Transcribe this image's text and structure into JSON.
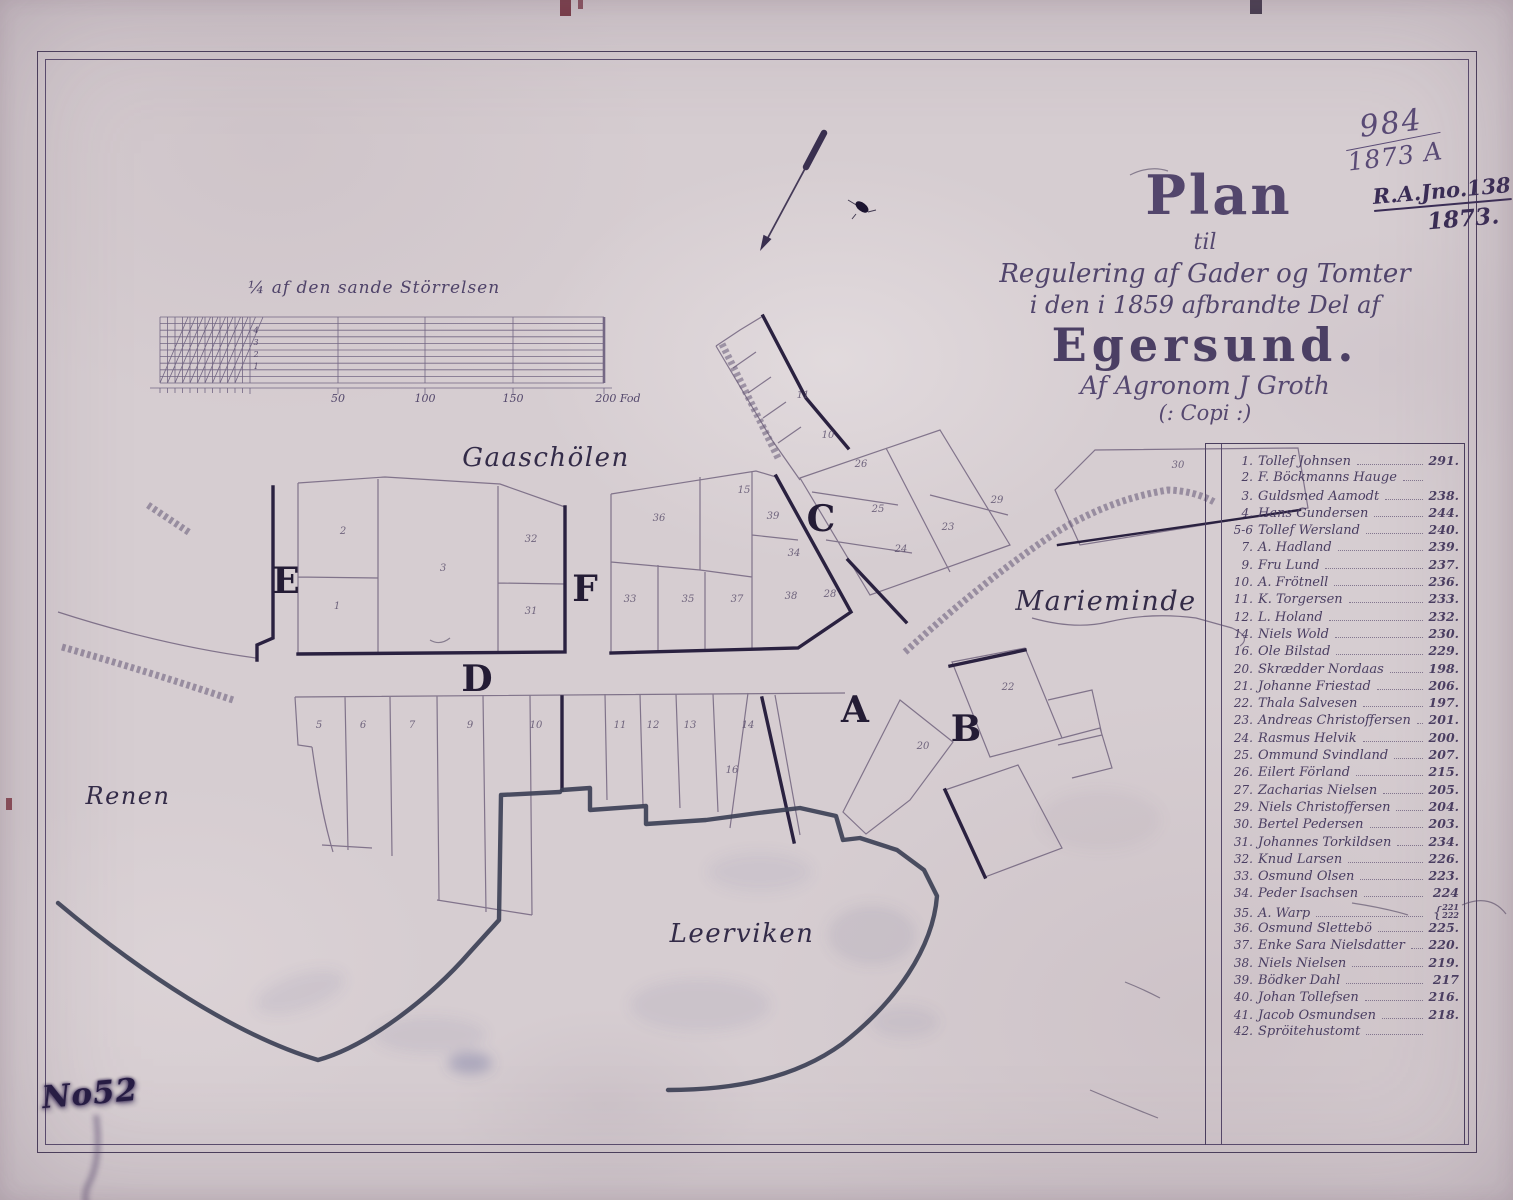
{
  "annotations": {
    "registry_number": "984",
    "registry_year": "1873 A",
    "reference_number": "R.A.Jno.138",
    "reference_year": "1873.",
    "corner_mark": "No52"
  },
  "title_block": {
    "line1": "Plan",
    "line2": "til",
    "line3": "Regulering af Gader og Tomter",
    "line4": "i den i 1859 afbrandte Del af",
    "line5": "Egersund.",
    "line6": "Af Agronom J Groth",
    "line7": "(: Copi :)"
  },
  "scale_bar": {
    "caption": "¼ af den sande Störrelsen",
    "ticks": [
      {
        "label": "50",
        "x": 338
      },
      {
        "label": "100",
        "x": 425
      },
      {
        "label": "150",
        "x": 513
      },
      {
        "label": "200 Fod",
        "x": 618
      }
    ],
    "diagonal_labels": [
      {
        "label": "4",
        "x": 256,
        "y": 333
      },
      {
        "label": "3",
        "x": 256,
        "y": 345
      },
      {
        "label": "2",
        "x": 256,
        "y": 357
      },
      {
        "label": "1",
        "x": 256,
        "y": 369
      }
    ]
  },
  "map": {
    "place_labels": [
      {
        "name": "Gaaschölen",
        "x": 546,
        "y": 466,
        "size": 26
      },
      {
        "name": "Marieminde",
        "x": 1106,
        "y": 610,
        "size": 27
      },
      {
        "name": "Renen",
        "x": 128,
        "y": 804,
        "size": 24
      },
      {
        "name": "Leerviken",
        "x": 742,
        "y": 942,
        "size": 26
      }
    ],
    "section_letters": [
      {
        "letter": "E",
        "x": 286,
        "y": 593
      },
      {
        "letter": "F",
        "x": 585,
        "y": 601
      },
      {
        "letter": "D",
        "x": 477,
        "y": 691
      },
      {
        "letter": "C",
        "x": 821,
        "y": 531
      },
      {
        "letter": "A",
        "x": 855,
        "y": 722
      },
      {
        "letter": "B",
        "x": 966,
        "y": 741
      }
    ],
    "lot_numbers": [
      {
        "n": "2",
        "x": 343,
        "y": 534
      },
      {
        "n": "3",
        "x": 443,
        "y": 571
      },
      {
        "n": "1",
        "x": 337,
        "y": 609
      },
      {
        "n": "32",
        "x": 531,
        "y": 542
      },
      {
        "n": "31",
        "x": 531,
        "y": 614
      },
      {
        "n": "36",
        "x": 659,
        "y": 521
      },
      {
        "n": "15",
        "x": 744,
        "y": 493
      },
      {
        "n": "39",
        "x": 773,
        "y": 519
      },
      {
        "n": "34",
        "x": 794,
        "y": 556
      },
      {
        "n": "33",
        "x": 630,
        "y": 602
      },
      {
        "n": "35",
        "x": 688,
        "y": 602
      },
      {
        "n": "37",
        "x": 737,
        "y": 602
      },
      {
        "n": "38",
        "x": 791,
        "y": 599
      },
      {
        "n": "28",
        "x": 830,
        "y": 597
      },
      {
        "n": "11",
        "x": 803,
        "y": 398
      },
      {
        "n": "10",
        "x": 828,
        "y": 438
      },
      {
        "n": "26",
        "x": 861,
        "y": 467
      },
      {
        "n": "25",
        "x": 878,
        "y": 512
      },
      {
        "n": "24",
        "x": 901,
        "y": 552
      },
      {
        "n": "23",
        "x": 948,
        "y": 530
      },
      {
        "n": "29",
        "x": 997,
        "y": 503
      },
      {
        "n": "30",
        "x": 1178,
        "y": 468
      },
      {
        "n": "20",
        "x": 923,
        "y": 749
      },
      {
        "n": "22",
        "x": 1008,
        "y": 690
      },
      {
        "n": "5",
        "x": 319,
        "y": 728
      },
      {
        "n": "6",
        "x": 363,
        "y": 728
      },
      {
        "n": "7",
        "x": 412,
        "y": 728
      },
      {
        "n": "9",
        "x": 470,
        "y": 728
      },
      {
        "n": "10",
        "x": 536,
        "y": 728
      },
      {
        "n": "11",
        "x": 620,
        "y": 728
      },
      {
        "n": "12",
        "x": 653,
        "y": 728
      },
      {
        "n": "13",
        "x": 690,
        "y": 728
      },
      {
        "n": "14",
        "x": 748,
        "y": 728
      },
      {
        "n": "16",
        "x": 732,
        "y": 773
      }
    ]
  },
  "ledger": {
    "entries": [
      {
        "no": "1.",
        "name": "Tollef Johnsen",
        "value": "291."
      },
      {
        "no": "2.",
        "name": "F. Böckmanns Hauge",
        "value": ""
      },
      {
        "no": "3.",
        "name": "Guldsmed Aamodt",
        "value": "238."
      },
      {
        "no": "4.",
        "name": "Hans Gundersen",
        "value": "244."
      },
      {
        "no": "5-6",
        "name": "Tollef Wersland",
        "value": "240."
      },
      {
        "no": "7.",
        "name": "A. Hadland",
        "value": "239."
      },
      {
        "no": "9.",
        "name": "Fru Lund",
        "value": "237."
      },
      {
        "no": "10.",
        "name": "A. Frötnell",
        "value": "236."
      },
      {
        "no": "11.",
        "name": "K. Torgersen",
        "value": "233."
      },
      {
        "no": "12.",
        "name": "L. Holand",
        "value": "232."
      },
      {
        "no": "14.",
        "name": "Niels Wold",
        "value": "230."
      },
      {
        "no": "16.",
        "name": "Ole Bilstad",
        "value": "229."
      },
      {
        "no": "20.",
        "name": "Skrædder Nordaas",
        "value": "198."
      },
      {
        "no": "21.",
        "name": "Johanne Friestad",
        "value": "206."
      },
      {
        "no": "22.",
        "name": "Thala Salvesen",
        "value": "197."
      },
      {
        "no": "23.",
        "name": "Andreas Christoffersen",
        "value": "201."
      },
      {
        "no": "24.",
        "name": "Rasmus Helvik",
        "value": "200."
      },
      {
        "no": "25.",
        "name": "Ommund Svindland",
        "value": "207."
      },
      {
        "no": "26.",
        "name": "Eilert Förland",
        "value": "215."
      },
      {
        "no": "27.",
        "name": "Zacharias Nielsen",
        "value": "205."
      },
      {
        "no": "29.",
        "name": "Niels Christoffersen",
        "value": "204."
      },
      {
        "no": "30.",
        "name": "Bertel Pedersen",
        "value": "203."
      },
      {
        "no": "31.",
        "name": "Johannes Torkildsen",
        "value": "234."
      },
      {
        "no": "32.",
        "name": "Knud Larsen",
        "value": "226."
      },
      {
        "no": "33.",
        "name": "Osmund Olsen",
        "value": "223."
      },
      {
        "no": "34.",
        "name": "Peder Isachsen",
        "value": "224"
      },
      {
        "no": "35.",
        "name": "A. Warp",
        "value": "221|222"
      },
      {
        "no": "36.",
        "name": "Osmund Slettebö",
        "value": "225."
      },
      {
        "no": "37.",
        "name": "Enke Sara Nielsdatter",
        "value": "220."
      },
      {
        "no": "38.",
        "name": "Niels Nielsen",
        "value": "219."
      },
      {
        "no": "39.",
        "name": "Bödker Dahl",
        "value": "217"
      },
      {
        "no": "40.",
        "name": "Johan Tollefsen",
        "value": "216."
      },
      {
        "no": "41.",
        "name": "Jacob Osmundsen",
        "value": "218."
      },
      {
        "no": "42.",
        "name": "Spröitehustomt",
        "value": ""
      }
    ]
  }
}
